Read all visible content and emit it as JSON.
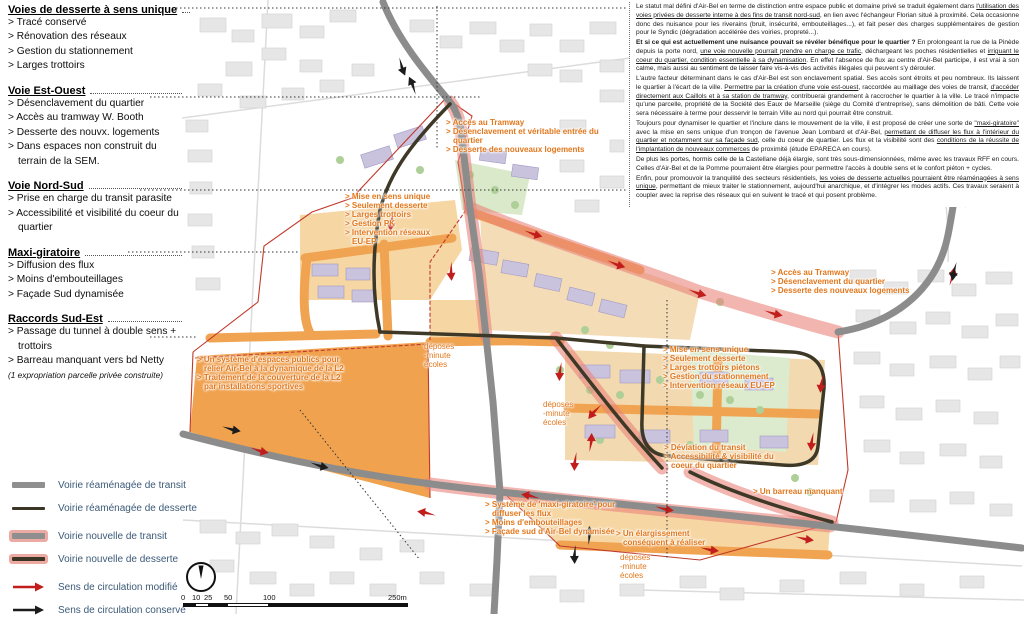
{
  "colors": {
    "transit_gray": "#8f8f8f",
    "service_dark": "#3c3626",
    "new_road_glow": "#edaaa2",
    "arrow_modified_red": "#c21d1d",
    "arrow_kept_black": "#1c1c1c",
    "callout_orange": "#e2771c",
    "boundary_red": "#c0392b",
    "legend_text_blue": "#3c5a78"
  },
  "sidebar": {
    "sections": [
      {
        "title": "Voies de desserte à sens unique",
        "items": [
          "> Tracé conservé",
          "> Rénovation des réseaux",
          "> Gestion du stationnement",
          "> Larges trottoirs"
        ]
      },
      {
        "title": "Voie Est-Ouest",
        "items": [
          "> Désenclavement du quartier",
          "> Accès au tramway W. Booth",
          "> Desserte des nouvx. logements",
          "> Dans espaces non construit du terrain de la SEM."
        ]
      },
      {
        "title": "Voie Nord-Sud",
        "items": [
          "> Prise en charge du transit parasite",
          "> Accessibilité et visibilité du coeur du quartier"
        ]
      },
      {
        "title": "Maxi-giratoire",
        "items": [
          "> Diffusion des flux",
          "> Moins d'embouteillages",
          "> Façade Sud dynamisée"
        ]
      },
      {
        "title": "Raccords Sud-Est",
        "items": [
          "> Passage du tunnel à double sens + trottoirs",
          "> Barreau manquant vers bd Netty"
        ],
        "note": "(1 expropriation parcelle privée construite)"
      }
    ]
  },
  "legend": {
    "items": [
      {
        "label": "Voirie réaménagée de transit",
        "swatch": "road-transit-reworked"
      },
      {
        "label": "Voirie réaménagée de desserte",
        "swatch": "road-service-reworked"
      },
      {
        "label": "Voirie nouvelle de transit",
        "swatch": "road-transit-new"
      },
      {
        "label": "Voirie nouvelle de desserte",
        "swatch": "road-service-new"
      },
      {
        "label": "Sens de circulation modifié",
        "swatch": "arrow-modified"
      },
      {
        "label": "Sens de circulation conservé",
        "swatch": "arrow-kept"
      }
    ]
  },
  "scalebar": {
    "ticks": [
      "0",
      "10",
      "25",
      "50",
      "100"
    ],
    "end_label": "250m"
  },
  "narrative": {
    "paragraphs": [
      [
        {
          "t": "Le statut mal défini d'Air-Bel en terme de distinction entre espace public et domaine privé se traduit également dans "
        },
        {
          "t": "l'utilisation des voies privées de desserte interne à des fins de transit nord-sud",
          "u": true
        },
        {
          "t": ", en lien avec l'échangeur Florian situé à proximité. Cela occasionne donc des nuisance pour les riverains (bruit, insécurité, embouteillages...), et fait peser des charges supplémentaires de gestion pour le Syndic (dégradation accélérée des voiries, propreté...)."
        }
      ],
      [
        {
          "t": "Et si ce qui est actuellement une nuisance pouvait se révéler bénéfique pour le quartier ?",
          "b": true
        },
        {
          "t": " En prolongeant la rue de la Pinède depuis la porte nord, "
        },
        {
          "t": "une voie nouvelle pourrait prendre en charge ce trafic",
          "u": true
        },
        {
          "t": ", déchargeant les poches résidentielles et "
        },
        {
          "t": "irriguant le coeur du quartier, condition essentielle à sa dynamisation",
          "u": true
        },
        {
          "t": ". En effet l'absence de flux au centre d'Air-Bel participe, il est vrai à son calme, mais aussi au sentiment de laisser faire vis-à-vis des activités illégales qui peuvent s'y dérouler."
        }
      ],
      [
        {
          "t": "L'autre facteur déterminant dans le cas d'Air-Bel est son enclavement spatial. Ses accès sont étroits et peu nombreux. Ils laissent le quartier à l'écart de la ville. "
        },
        {
          "t": "Permettre par la création d'une voie est-ouest",
          "u": true
        },
        {
          "t": ", raccordée au maillage des voies de transit, "
        },
        {
          "t": "d'accéder directement aux Caillols et à sa station de tramway",
          "u": true
        },
        {
          "t": ", contribuerai grandement à raccrocher le quartier à la ville. Le tracé n'impacte qu'une parcelle, propriété de la Société des Eaux de Marseille (siège du Comité d'entreprise), sans démolition de bâti. Cette voie sera nécessaire à terme pour desservir le terrain Ville au nord qui pourrait être construit."
        }
      ],
      [
        {
          "t": "Toujours pour dynamiser le quartier et l'inclure dans le mouvement de la ville, il est proposé de créer une sorte de "
        },
        {
          "t": "\"maxi-giratoire\"",
          "u": true
        },
        {
          "t": " avec la mise en sens unique d'un tronçon de l'avenue Jean Lombard et d'Air-Bel, "
        },
        {
          "t": "permettant de diffuser les flux à l'intérieur du quartier et notamment sur sa façade sud",
          "u": true
        },
        {
          "t": ", celle du coeur de quartier. Les flux et la visibilité sont des "
        },
        {
          "t": "conditions de la réussite de l'implantation de nouveaux commerces",
          "u": true
        },
        {
          "t": " de proximité (étude EPARECA en cours)."
        }
      ],
      [
        {
          "t": "De plus les portes, hormis celle de la Castellane déjà élargie, sont très sous-dimensionnées, même avec les travaux RFF en cours. Celles d'Air-Bel et de la Pomme pourraient être élargies pour permettre l'accès à double sens et le confort piéton + cycles."
        }
      ],
      [
        {
          "t": "Enfin, pour promouvoir la tranquilité des secteurs résidentiels, "
        },
        {
          "t": "les voies de desserte actuelles pourraient être réaménagées à sens unique",
          "u": true
        },
        {
          "t": ", permettant de mieux traiter le stationnement, aujourd'hui anarchique, et d'intégrer les modes actifs. Ces travaux seraient à coupler avec la reprise des réseaux qui en suivent le tracé et qui posent problème."
        }
      ]
    ]
  },
  "map": {
    "callouts": [
      {
        "lines": [
          "> Accès au Tramway",
          "> Désenclavement et véritable entrée du quartier",
          "> Desserte des nouveaux logements"
        ]
      },
      {
        "lines": [
          "> Mise en sens unique",
          "> Seulement desserte",
          "> Larges trottoirs",
          "> Gestion PK",
          "> Intervention réseaux EU-EP"
        ]
      },
      {
        "lines": [
          "> Accès au Tramway",
          "> Désenclavement du quartier",
          "> Desserte des nouveaux logements"
        ]
      },
      {
        "lines": [
          "> Mise en sens unique",
          "> Seulement desserte",
          "> Larges trottoirs piétons",
          "> Gestion du stationnement",
          "> Intervention réseaux EU-EP"
        ]
      },
      {
        "lines": [
          "> Un système d'espaces publics pour relier Air-Bel à la dynamique de la L2",
          "> Traitement de la couverture de la L2 par installations sportives"
        ]
      },
      {
        "lines": [
          "déposes",
          "-minute",
          "écoles"
        ]
      },
      {
        "lines": [
          "déposes",
          "-minute",
          "écoles"
        ]
      },
      {
        "lines": [
          "déposes",
          "-minute",
          "écoles"
        ]
      },
      {
        "lines": [
          "> Déviation du transit",
          "> Accessibilité & visibilité du coeur du quartier"
        ]
      },
      {
        "lines": [
          "> Un barreau manquant"
        ]
      },
      {
        "lines": [
          "> Système de 'maxi-giratoire' pour diffuser les flux",
          "> Moins d'embouteillages",
          "> Façade sud d'Air-Bel dynamisée"
        ]
      },
      {
        "lines": [
          "> Un élargissement conséquent à réaliser"
        ]
      }
    ]
  }
}
